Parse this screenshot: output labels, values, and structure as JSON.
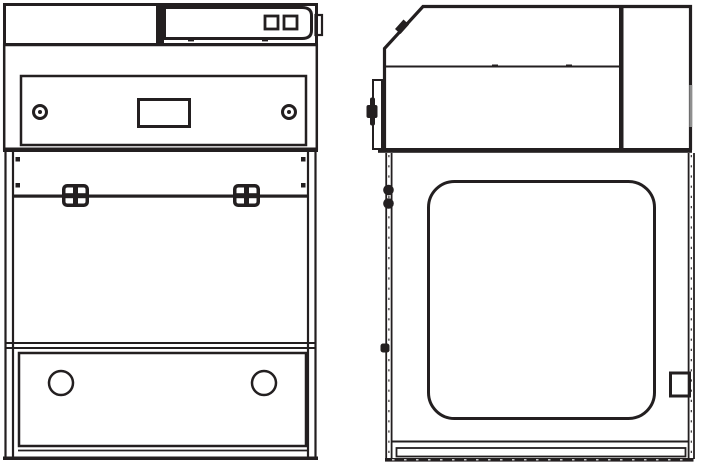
{
  "diagram": {
    "type": "technical-line-drawing",
    "subject": "Benchtop fume hood cabinet shown in two orthographic elevation views",
    "text_labels": [],
    "colors": {
      "background": "#ffffff",
      "line": "#231f20",
      "edge_accent_gray": "#8f8f8f"
    },
    "views": [
      {
        "id": "front-elevation",
        "position": "left",
        "components": [
          "top-housing-band",
          "control-panel",
          "panel-button-left",
          "panel-button-right",
          "panel-side-tab",
          "head-housing",
          "front-access-panel",
          "display-cutout",
          "knob-left",
          "knob-right",
          "side-post-left",
          "side-post-right",
          "sash-rail",
          "sash-clamp-left",
          "sash-clamp-right",
          "worktop-line",
          "base-panel",
          "port-hole-left",
          "port-hole-right",
          "base-strip"
        ],
        "counts": {
          "buttons": 2,
          "knobs": 2,
          "sash_clamps": 2,
          "port_holes": 2
        }
      },
      {
        "id": "side-elevation",
        "position": "right",
        "components": [
          "sloped-top-edge",
          "slant-hinge-bump",
          "head-housing",
          "head-split-line",
          "rear-column-divider",
          "hinge-bracket",
          "latch-knob",
          "front-track",
          "hinge-pin-upper",
          "hinge-pin-lower",
          "track-stop",
          "side-window",
          "rear-track",
          "rear-handle",
          "base-rail",
          "bottom-strip"
        ],
        "counts": {
          "hinge_pins": 2,
          "windows": 1,
          "handles": 1
        }
      }
    ]
  }
}
